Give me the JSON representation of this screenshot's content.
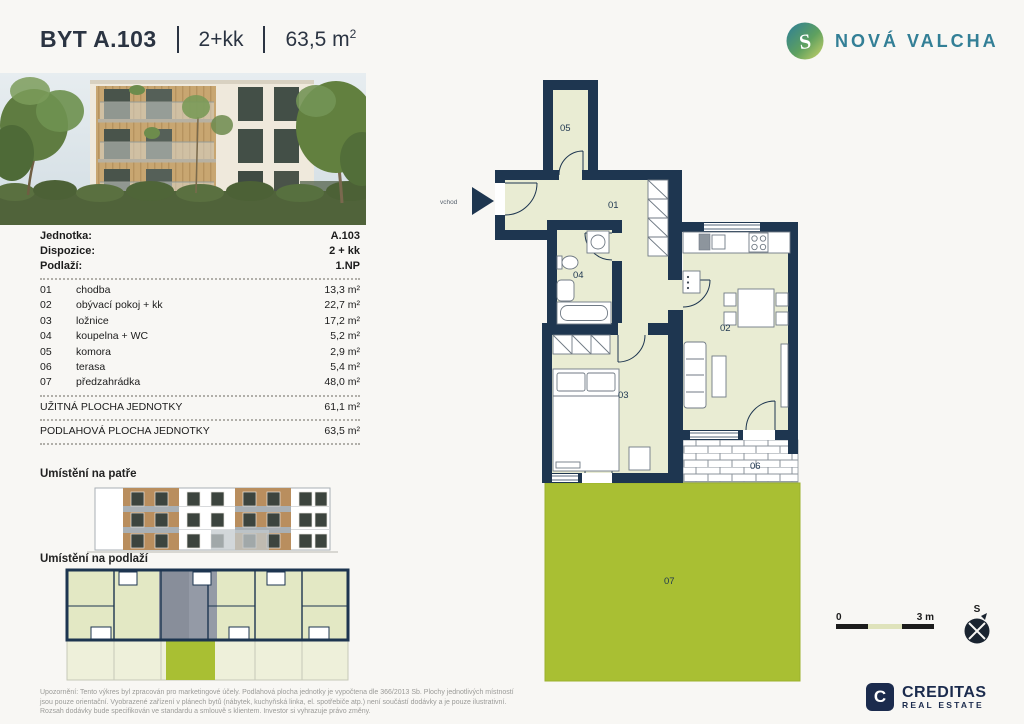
{
  "header": {
    "title": "BYT A.103",
    "layout": "2+kk",
    "area_value": "63,5 m",
    "area_sup": "2"
  },
  "brand": {
    "name": "NOVÁ VALCHA",
    "logo_letter": "S"
  },
  "unit_info": [
    {
      "label": "Jednotka:",
      "value": "A.103"
    },
    {
      "label": "Dispozice:",
      "value": "2 + kk"
    },
    {
      "label": "Podlaží:",
      "value": "1.NP"
    }
  ],
  "rooms": [
    {
      "num": "01",
      "name": "chodba",
      "area": "13,3 m²"
    },
    {
      "num": "02",
      "name": "obývací pokoj + kk",
      "area": "22,7 m²"
    },
    {
      "num": "03",
      "name": "ložnice",
      "area": "17,2 m²"
    },
    {
      "num": "04",
      "name": "koupelna + WC",
      "area": "5,2 m²"
    },
    {
      "num": "05",
      "name": "komora",
      "area": "2,9 m²"
    },
    {
      "num": "06",
      "name": "terasa",
      "area": "5,4 m²"
    },
    {
      "num": "07",
      "name": "předzahrádka",
      "area": "48,0 m²"
    }
  ],
  "totals": [
    {
      "label": "UŽITNÁ PLOCHA JEDNOTKY",
      "value": "61,1 m²"
    },
    {
      "label": "PODLAHOVÁ PLOCHA JEDNOTKY",
      "value": "63,5 m²"
    }
  ],
  "sections": {
    "floor": "Umístění na patře",
    "level": "Umístění na podlaží"
  },
  "plan": {
    "entrance": "vchod",
    "labels": [
      "01",
      "02",
      "03",
      "04",
      "05",
      "06",
      "07"
    ],
    "scale_start": "0",
    "scale_end": "3 m",
    "compass": "S"
  },
  "footer": {
    "lines": [
      "Upozornění: Tento výkres byl zpracován pro marketingové účely. Podlahová plocha jednotky je vypočtena dle 366/2013 Sb. Plochy jednotlivých místností",
      "jsou pouze orientační. Vyobrazené zařízení v plánech bytů (nábytek, kuchyňská linka, el. spotřebiče atp.) není součástí dodávky a je pouze ilustrativní.",
      "Rozsah dodávky bude specifikován ve standardu a smlouvě s klientem. Investor si vyhrazuje právo změny."
    ],
    "creditas_name": "CREDITAS",
    "creditas_sub": "REAL ESTATE",
    "creditas_icon": "C"
  },
  "colors": {
    "wall": "#1E3650",
    "room": "#E9ECD3",
    "garden": "#A9BF33",
    "teal": "#337F96",
    "navy": "#1B2B4D"
  }
}
